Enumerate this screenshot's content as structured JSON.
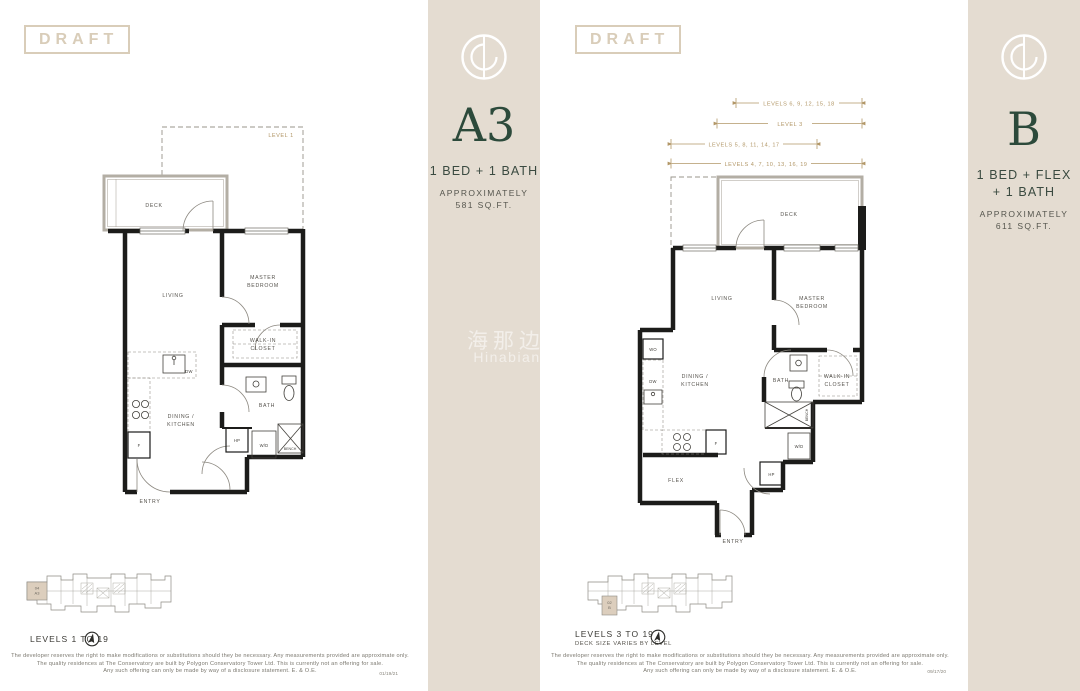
{
  "watermark": {
    "cn": "海那边",
    "en": "Hinabian"
  },
  "disclaimer_lines": [
    "The developer reserves the right to make modifications or substitutions should they be necessary. Any measurements provided are approximate only.",
    "The quality residences at The Conservatory are built by Polygon Conservatory Tower Ltd. This is currently not an offering for sale.",
    "Any such offering can only be made by way of a disclosure statement. E. & O.E."
  ],
  "pages": [
    {
      "draft_label": "DRAFT",
      "plan_name": "A3",
      "type_lines": [
        "1 BED + 1 BATH"
      ],
      "approx_lines": [
        "APPROXIMATELY",
        "581 SQ.FT."
      ],
      "levels_lines": [
        "LEVELS 1 TO 19"
      ],
      "keyplan_unit_line1": "04",
      "keyplan_unit_line2": "A3",
      "date": "01/19/21",
      "plan": {
        "level_note": "LEVEL 1",
        "deck": "DECK",
        "living": "LIVING",
        "master_1": "MASTER",
        "master_2": "BEDROOM",
        "walkin_1": "WALK-IN",
        "walkin_2": "CLOSET",
        "bath": "BATH",
        "dining_1": "DINING /",
        "dining_2": "KITCHEN",
        "entry": "ENTRY",
        "bench": "BENCH",
        "f": "F",
        "dw": "DW",
        "hp": "HP",
        "wd": "W/D"
      }
    },
    {
      "draft_label": "DRAFT",
      "plan_name": "B",
      "type_lines": [
        "1 BED + FLEX",
        "+ 1 BATH"
      ],
      "approx_lines": [
        "APPROXIMATELY",
        "611 SQ.FT."
      ],
      "levels_lines": [
        "LEVELS 3 TO 19",
        "DECK SIZE VARIES BY LEVEL"
      ],
      "keyplan_unit_line1": "02",
      "keyplan_unit_line2": "B",
      "date": "09/17/20",
      "plan": {
        "dim_labels": [
          "LEVELS 6, 9, 12, 15, 18",
          "LEVEL 3",
          "LEVELS 5, 8, 11, 14, 17",
          "LEVELS 4, 7, 10, 13, 16, 19"
        ],
        "deck": "DECK",
        "living": "LIVING",
        "master_1": "MASTER",
        "master_2": "BEDROOM",
        "walkin_1": "WALK-IN",
        "walkin_2": "CLOSET",
        "bath": "BATH",
        "dining_1": "DINING /",
        "dining_2": "KITCHEN",
        "entry": "ENTRY",
        "bench": "BENCH",
        "flex": "FLEX",
        "f": "F",
        "dw": "DW",
        "wo": "WO",
        "hp": "HP",
        "wd": "W/D"
      }
    }
  ]
}
